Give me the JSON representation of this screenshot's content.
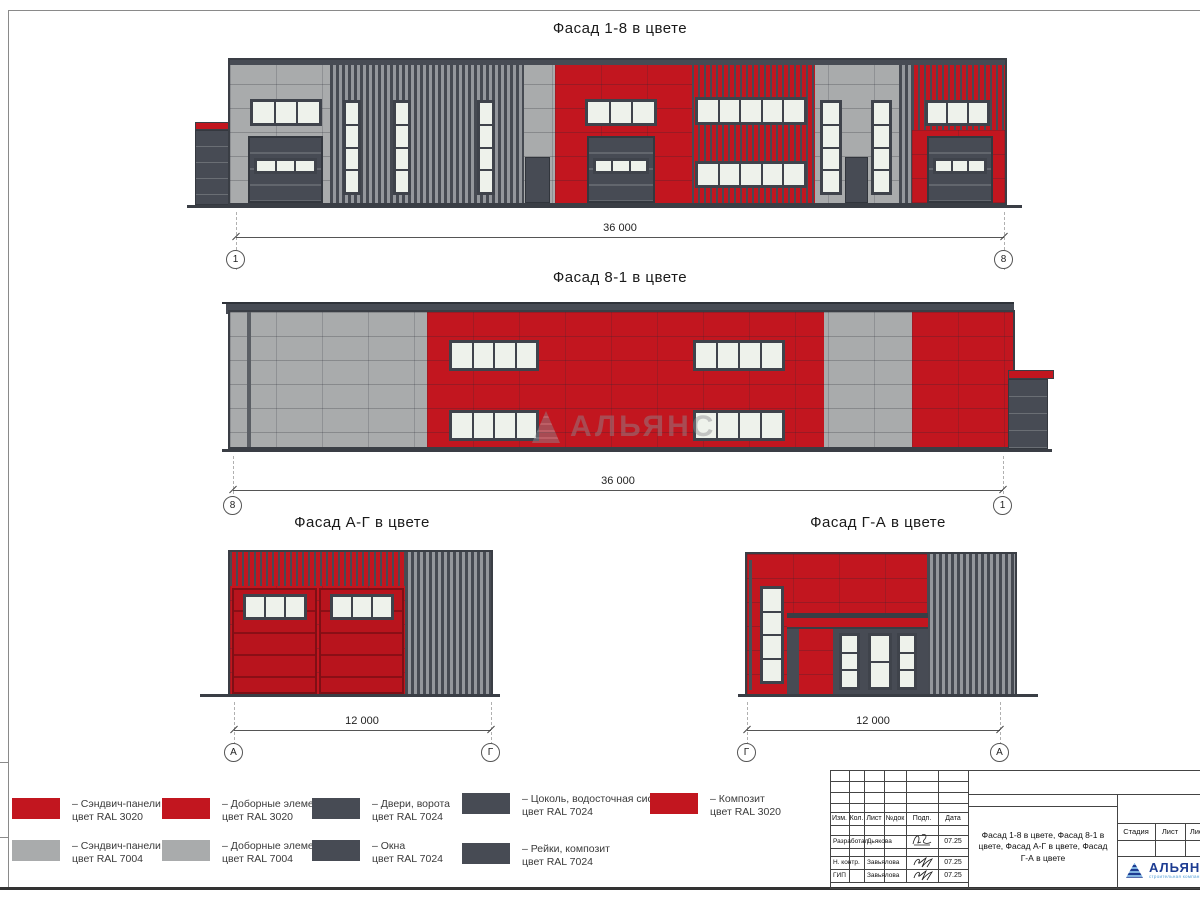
{
  "facades": [
    {
      "title": "Фасад 1-8 в цвете",
      "dimension": "36 000",
      "axis_left": "1",
      "axis_right": "8"
    },
    {
      "title": "Фасад 8-1 в цвете",
      "dimension": "36 000",
      "axis_left": "8",
      "axis_right": "1"
    },
    {
      "title": "Фасад А-Г в цвете",
      "dimension": "12 000",
      "axis_left": "А",
      "axis_right": "Г"
    },
    {
      "title": "Фасад Г-А в цвете",
      "dimension": "12 000",
      "axis_left": "Г",
      "axis_right": "А"
    }
  ],
  "watermark": {
    "text": "АЛЬЯНС"
  },
  "colors": {
    "red_ral3020": "#c2161f",
    "gray_ral7004": "#a9abac",
    "dark_ral7024": "#474b54",
    "glass": "#eef2eb"
  },
  "legend": {
    "items": [
      {
        "x": 12,
        "y": 798,
        "color": "#c2161f",
        "line1": "– Сэндвич-панели",
        "line2": "цвет RAL 3020"
      },
      {
        "x": 162,
        "y": 798,
        "color": "#c2161f",
        "line1": "– Доборные элементы",
        "line2": "цвет RAL 3020"
      },
      {
        "x": 312,
        "y": 798,
        "color": "#474b54",
        "line1": "– Двери, ворота",
        "line2": "цвет RAL 7024"
      },
      {
        "x": 462,
        "y": 793,
        "color": "#474b54",
        "line1": "– Цоколь, водосточная система",
        "line2": "цвет RAL 7024"
      },
      {
        "x": 650,
        "y": 793,
        "color": "#c2161f",
        "line1": "– Композит",
        "line2": "цвет RAL 3020"
      },
      {
        "x": 12,
        "y": 840,
        "color": "#a9abac",
        "line1": "– Сэндвич-панели",
        "line2": "цвет RAL 7004"
      },
      {
        "x": 162,
        "y": 840,
        "color": "#a9abac",
        "line1": "– Доборные элементы",
        "line2": "цвет RAL 7004"
      },
      {
        "x": 312,
        "y": 840,
        "color": "#474b54",
        "line1": "– Окна",
        "line2": "цвет RAL 7024"
      },
      {
        "x": 462,
        "y": 843,
        "color": "#474b54",
        "line1": "– Рейки, композит",
        "line2": "цвет RAL 7024"
      }
    ]
  },
  "title_block": {
    "header": [
      "Изм.",
      "Кол.",
      "Лист",
      "№док",
      "Подп.",
      "Дата"
    ],
    "rows": [
      {
        "role": "Разработал",
        "name": "Дьякова",
        "date": "07.25"
      },
      {
        "role": "Н. контр.",
        "name": "Завьялова",
        "date": "07.25"
      },
      {
        "role": "ГИП",
        "name": "Завьялова",
        "date": "07.25"
      }
    ],
    "description": "Фасад 1-8 в цвете, Фасад 8-1 в цвете, Фасад А-Г в цвете, Фасад Г-А в цвете",
    "stage": [
      "Стадия",
      "Лист",
      "Листов"
    ],
    "logo": {
      "name": "АЛЬЯНС",
      "tagline": "строительная компания"
    }
  }
}
